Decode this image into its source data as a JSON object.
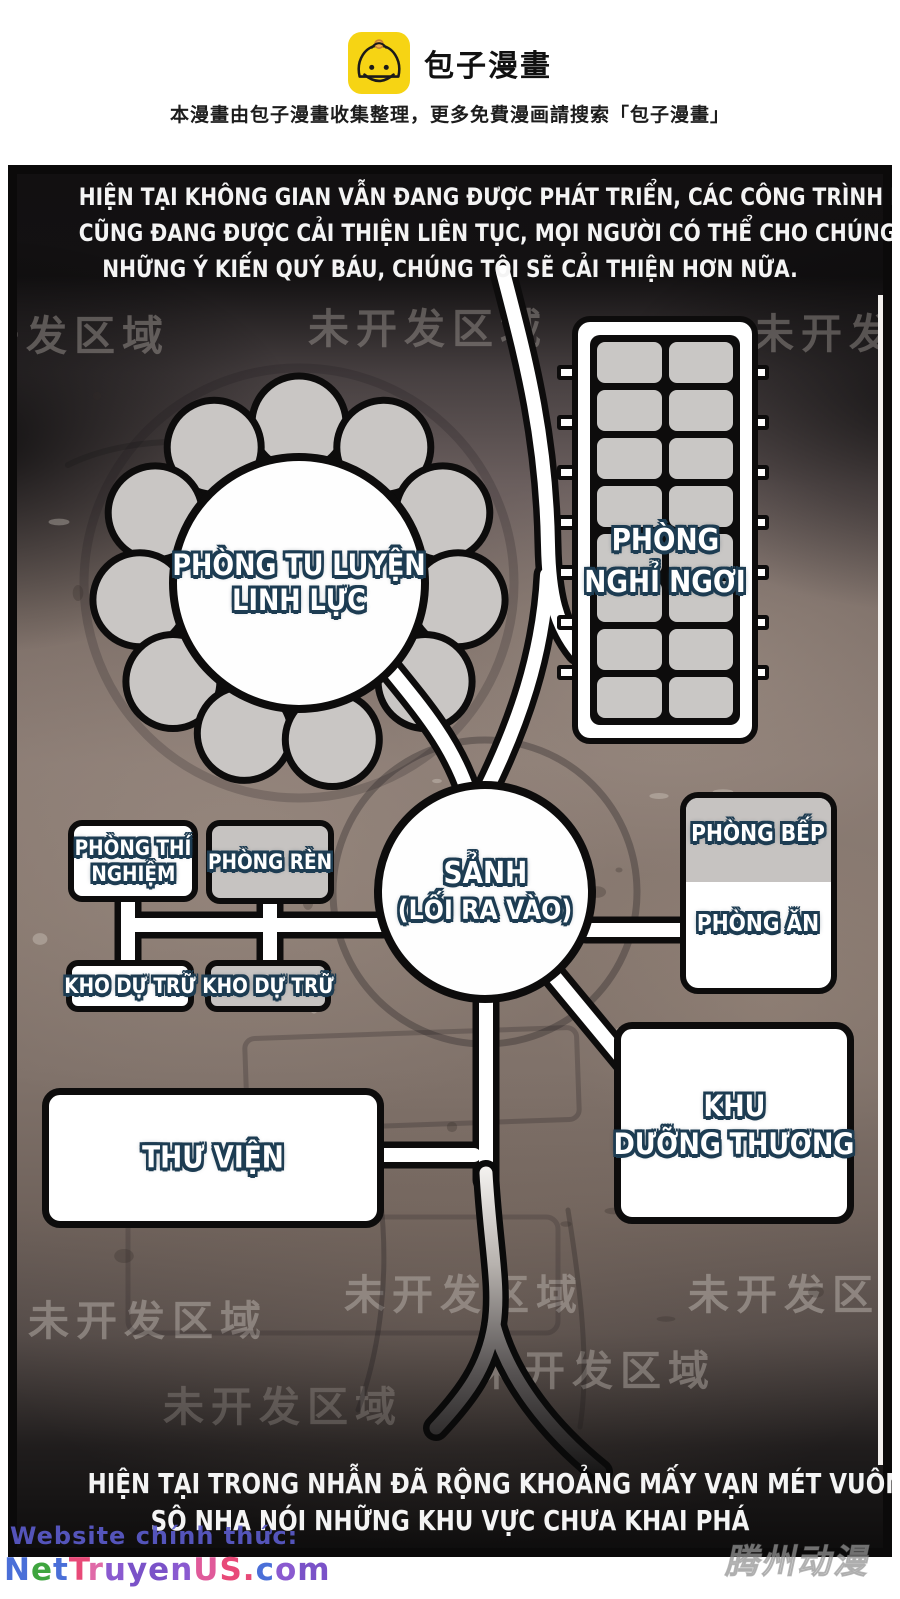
{
  "header": {
    "logo_text": "包子漫畫",
    "subtitle": "本漫畫由包子漫畫收集整理，更多免費漫画請搜索「包子漫畫」"
  },
  "panel": {
    "caption_top": {
      "line1": "HIỆN TẠI KHÔNG GIAN VẪN ĐANG ĐƯỢC PHÁT TRIỂN, CÁC CÔNG TRÌNH KHÁC NHAU",
      "line2": "CŨNG ĐANG ĐƯỢC CẢI THIỆN LIÊN TỤC, MỌI NGƯỜI CÓ THỂ CHO CHÚNG TÔI THÊM",
      "line3": "NHỮNG Ý KIẾN QUÝ BÁU, CHÚNG TÔI SẼ CẢI THIỆN HƠN NỮA."
    },
    "caption_bottom": {
      "line1": "HIỆN TẠI TRONG NHẪN ĐÃ RỘNG KHOẢNG MẤY VẠN MÉT VUÔNG,",
      "line2": "SÔ NHA NÓI NHỮNG KHU VỰC CHƯA KHAI PHÁ"
    },
    "watermark": "未开发区域",
    "rooms": {
      "cultivation": {
        "line1": "PHÒNG TU LUYỆN",
        "line2": "LINH LỰC"
      },
      "rest": {
        "line1": "PHÒNG",
        "line2": "NGHỈ NGƠI"
      },
      "lab": {
        "line1": "PHÒNG THÍ",
        "line2": "NGHIỆM"
      },
      "forge": {
        "label": "PHÒNG RÈN"
      },
      "storage_left": {
        "label": "KHO DỰ TRỮ"
      },
      "storage_right": {
        "label": "KHO DỰ TRỮ"
      },
      "hall": {
        "line1": "SẢNH",
        "line2": "(LỐI RA VÀO)"
      },
      "kitchen": {
        "label": "PHÒNG BẾP"
      },
      "dining": {
        "label": "PHÒNG ĂN"
      },
      "library": {
        "label": "THƯ VIỆN"
      },
      "infirmary": {
        "line1": "KHU",
        "line2": "DƯỠNG THƯƠNG"
      }
    },
    "colors": {
      "label_outline": "#1d3c52",
      "room_gray": "#c6c3c1",
      "room_white": "#ffffff",
      "panel_dirt": "#8a7b73"
    }
  },
  "footer": {
    "website_label": "Website chính thức:",
    "website_name": "NetTruyenUS.com",
    "publisher_watermark": "腾州动漫"
  }
}
